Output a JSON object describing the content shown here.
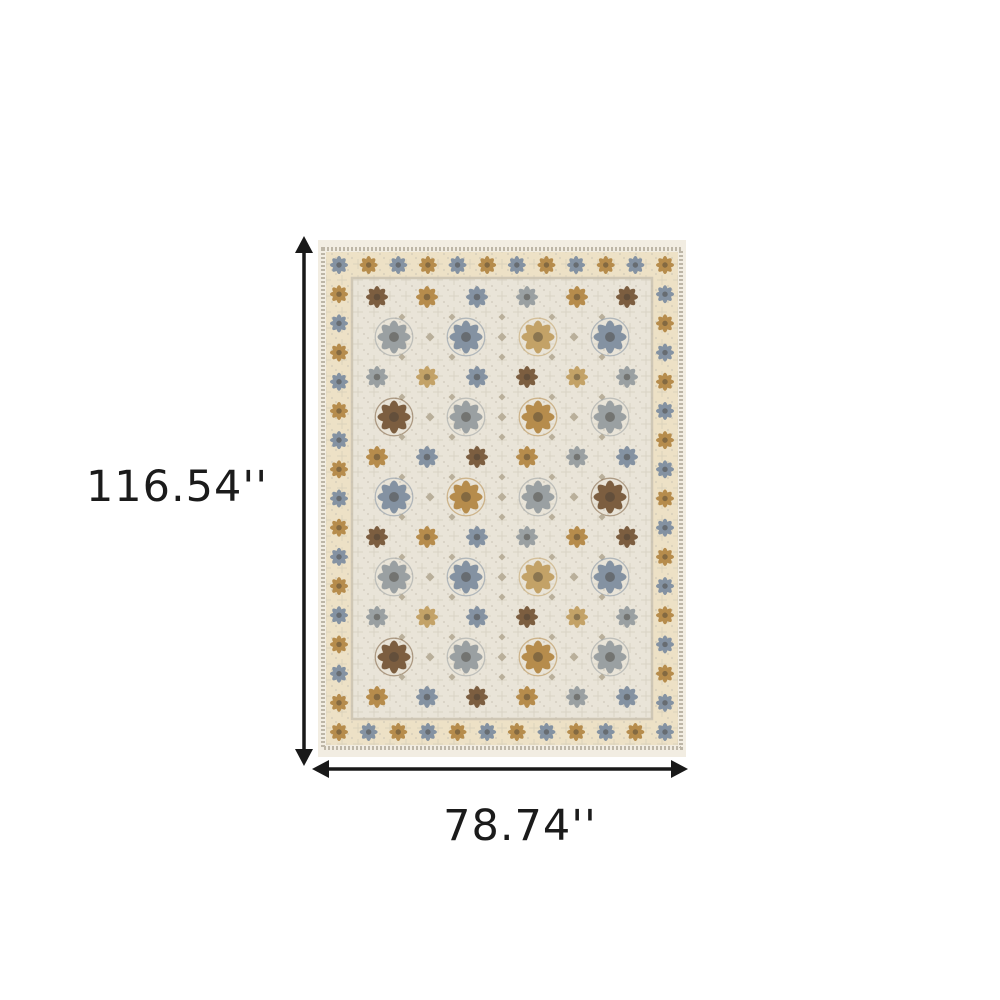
{
  "dimensions": {
    "height_label": "116.54''",
    "width_label": "78.74''"
  },
  "colors": {
    "background": "#ffffff",
    "arrow": "#191919",
    "text": "#1b1b1b"
  },
  "rug": {
    "description": "ivory oriental area rug with floral medallion rows and rosette border",
    "palette": {
      "rug_edge": "#f2ede2",
      "speckle": "#bdb6a7",
      "border_bg": "#ede1c6",
      "guard": "#cfc7b5",
      "field_bg": "#e9e4d8",
      "tracery": "#c9c2b2",
      "slate": "#8492a2",
      "silver": "#9aa0a2",
      "gold": "#b68c4c",
      "brown": "#7c5e40",
      "tan": "#c3a267",
      "accent": "#b0a68f",
      "center_dot": "#453f35"
    },
    "border": {
      "colors": [
        "slate",
        "gold"
      ]
    },
    "field_rows": [
      {
        "type": "medium",
        "colors": [
          "brown",
          "gold",
          "slate",
          "silver",
          "gold",
          "brown"
        ]
      },
      {
        "type": "large",
        "colors": [
          "silver",
          "slate",
          "tan",
          "slate"
        ]
      },
      {
        "type": "medium",
        "colors": [
          "silver",
          "tan",
          "slate",
          "brown",
          "tan",
          "silver"
        ]
      },
      {
        "type": "large",
        "colors": [
          "brown",
          "silver",
          "gold",
          "silver"
        ]
      },
      {
        "type": "medium",
        "colors": [
          "gold",
          "slate",
          "brown",
          "gold",
          "silver",
          "slate"
        ]
      },
      {
        "type": "large",
        "colors": [
          "slate",
          "gold",
          "silver",
          "brown"
        ]
      },
      {
        "type": "medium",
        "colors": [
          "brown",
          "gold",
          "slate",
          "silver",
          "gold",
          "brown"
        ]
      },
      {
        "type": "large",
        "colors": [
          "silver",
          "slate",
          "tan",
          "slate"
        ]
      },
      {
        "type": "medium",
        "colors": [
          "silver",
          "tan",
          "slate",
          "brown",
          "tan",
          "silver"
        ]
      },
      {
        "type": "large",
        "colors": [
          "brown",
          "silver",
          "gold",
          "silver"
        ]
      },
      {
        "type": "medium",
        "colors": [
          "gold",
          "slate",
          "brown",
          "gold",
          "silver",
          "slate"
        ]
      }
    ]
  }
}
